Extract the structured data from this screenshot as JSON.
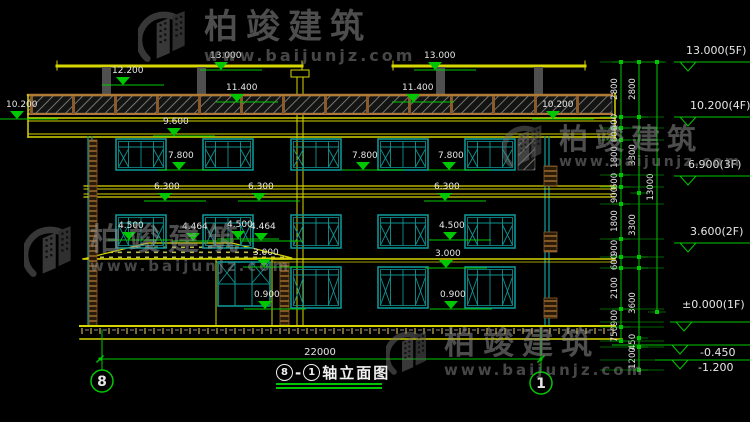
{
  "watermark": {
    "brand": "柏竣建筑",
    "url": "www.baijunjz.com"
  },
  "title": {
    "axis_start": "8",
    "dash": "-",
    "axis_end": "1",
    "name": "轴立面图"
  },
  "axis_bubbles": {
    "left": "8",
    "right": "1"
  },
  "bottom_dimension": "22000",
  "elevation_marks": {
    "inner": [
      "13.000",
      "13.000",
      "12.200",
      "11.400",
      "11.400",
      "10.200",
      "10.200",
      "9.600",
      "7.800",
      "7.800",
      "7.800",
      "6.300",
      "6.300",
      "6.300",
      "4.500",
      "4.464",
      "4.500",
      "4.464",
      "4.500",
      "3.000",
      "3.000",
      "0.900",
      "0.900"
    ],
    "right": [
      "13.000(5F)",
      "10.200(4F)",
      "6.900(3F)",
      "3.600(2F)",
      "±0.000(1F)",
      "-0.450",
      "-1.200"
    ]
  },
  "dimension_chains": {
    "col1": [
      "2800",
      "600",
      "600",
      "1800",
      "600",
      "900",
      "1800",
      "900",
      "600",
      "2100",
      "900",
      "750"
    ],
    "col2": [
      "2800",
      "3300",
      "3300",
      "3600",
      "450",
      "1200"
    ],
    "col3": [
      "13000"
    ]
  },
  "colors": {
    "background": "#000000",
    "cad_yellow": "#d6d600",
    "cad_teal": "#0d9494",
    "cad_green": "#00c800",
    "cad_white": "#e6e6e6",
    "cad_brown": "#8a5a2a"
  }
}
